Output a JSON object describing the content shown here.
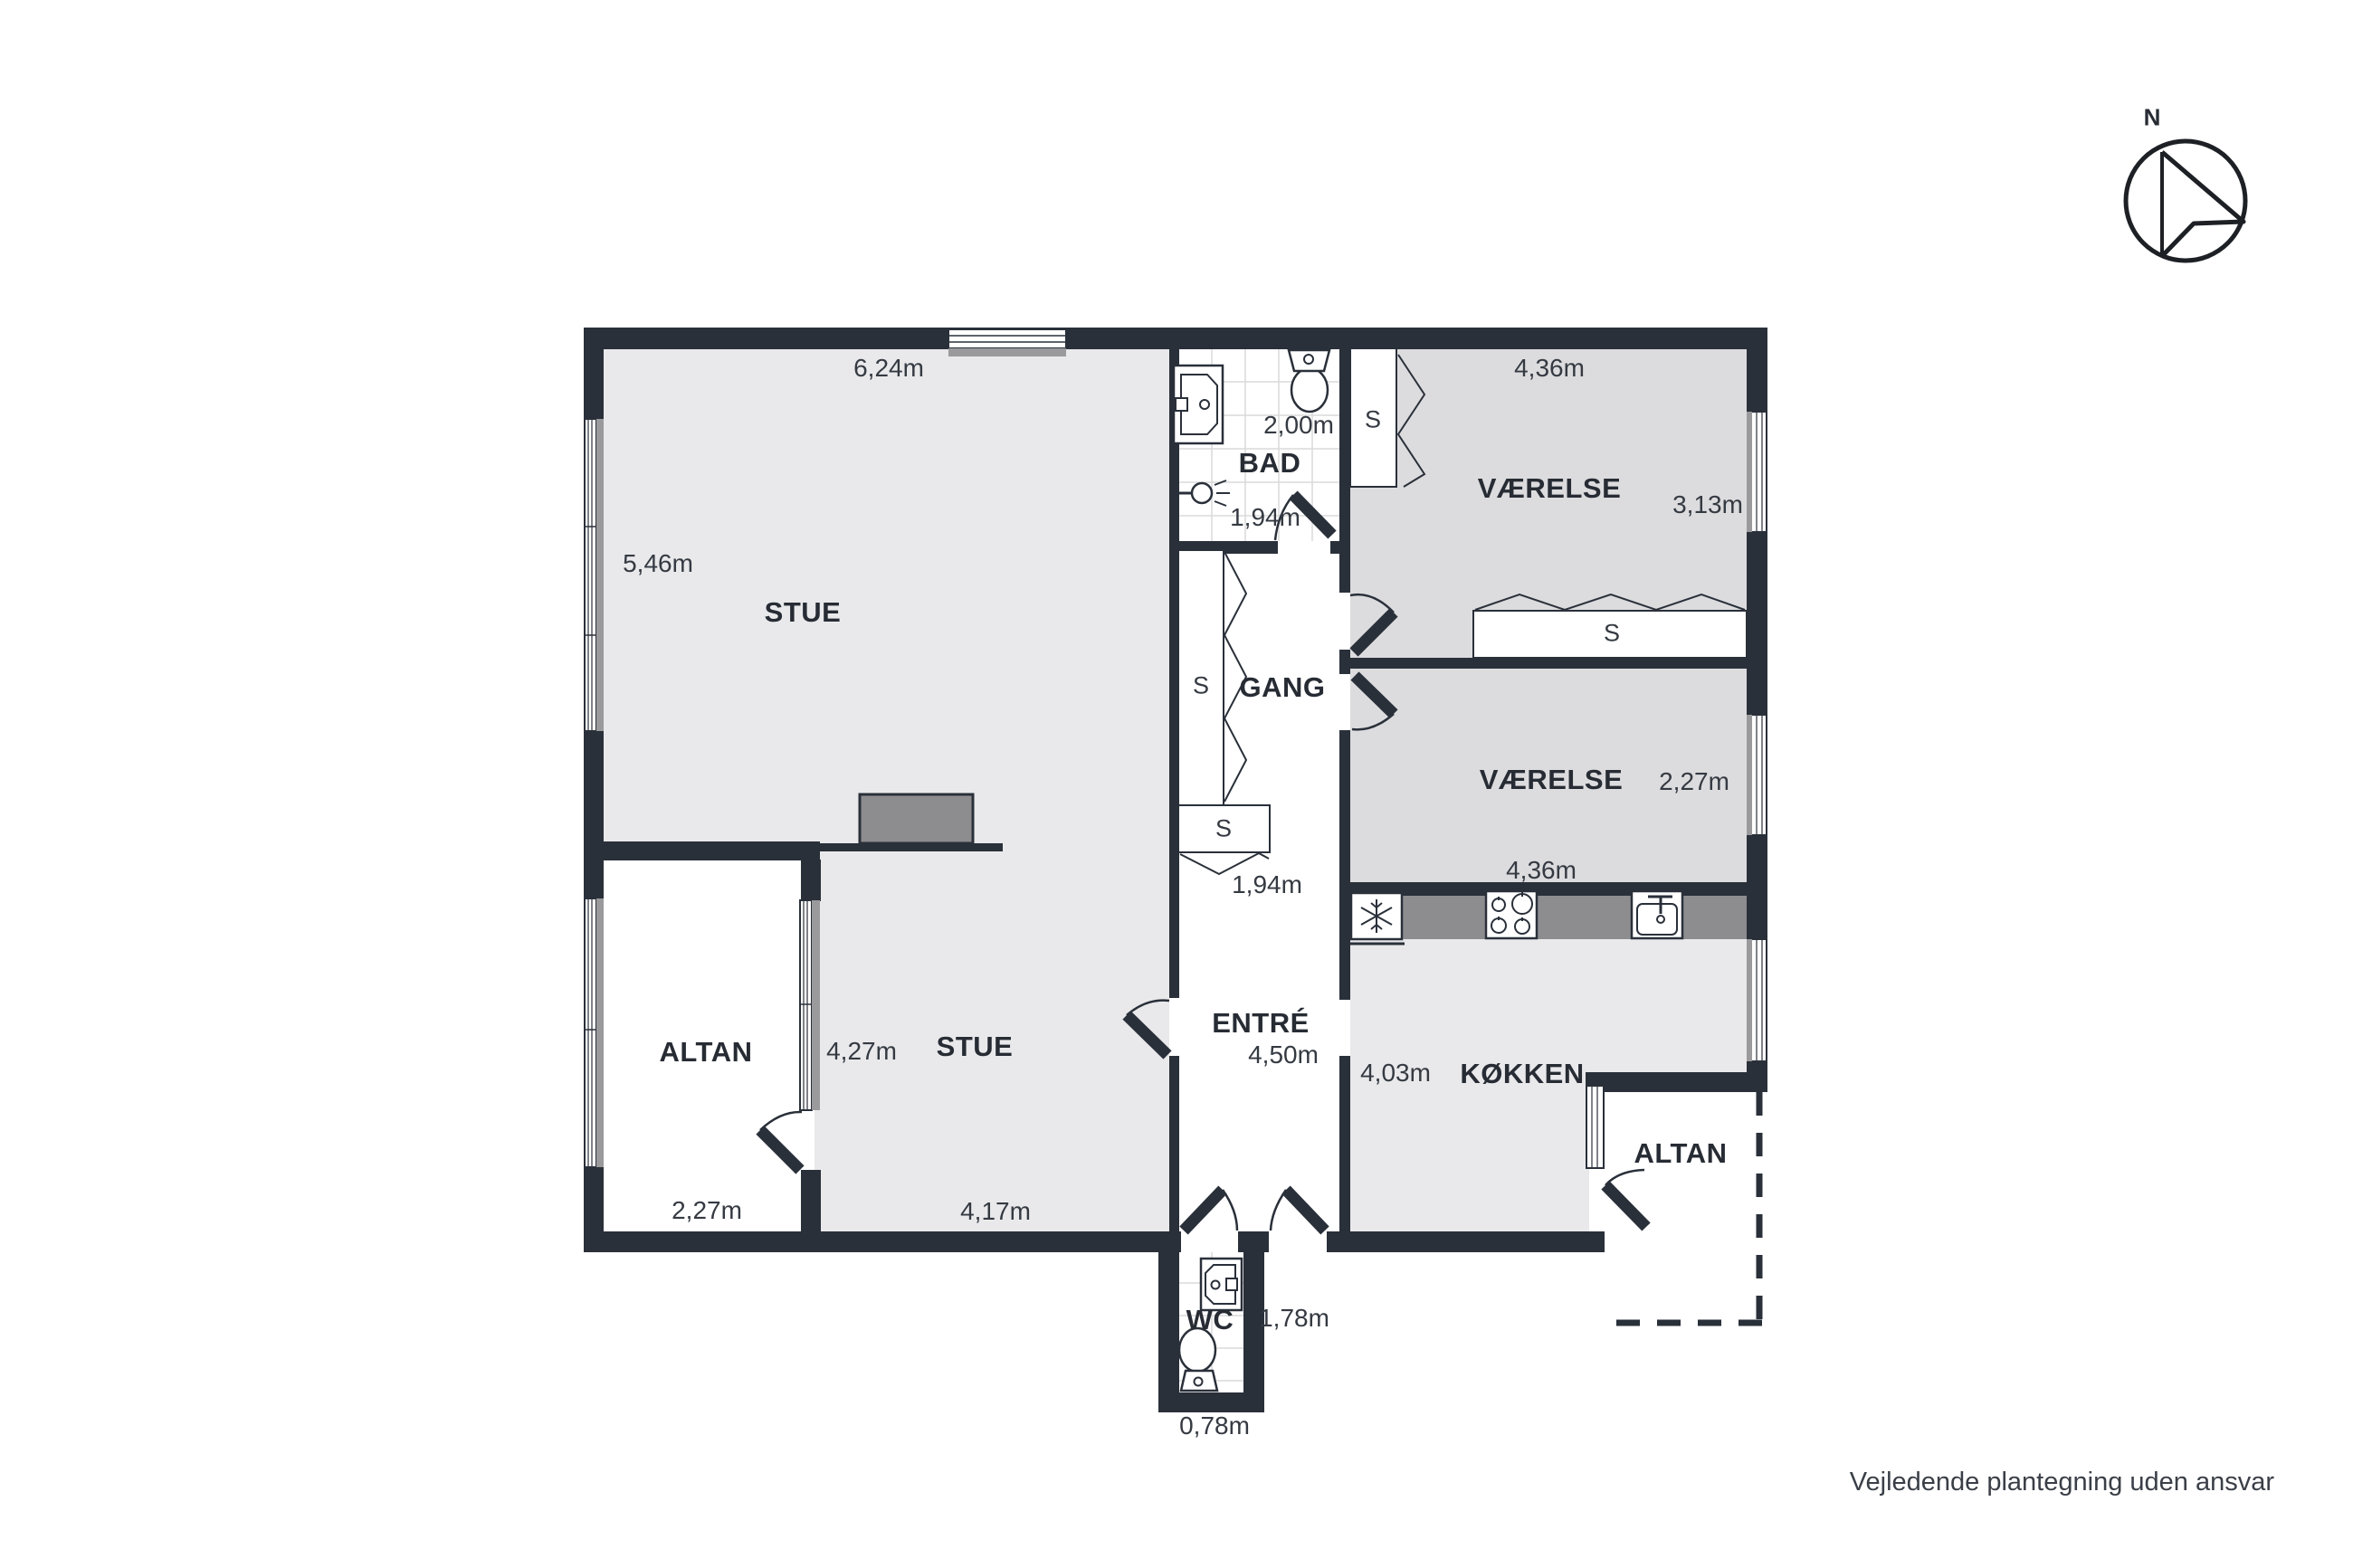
{
  "disclaimer": "Vejledende plantegning uden ansvar",
  "compass": {
    "label": "N"
  },
  "closet_symbol": "S",
  "rooms": {
    "stue1": {
      "name": "STUE",
      "top": "6,24m",
      "left": "5,46m"
    },
    "stue2": {
      "name": "STUE",
      "left": "4,27m",
      "bottom": "4,17m"
    },
    "bad": {
      "name": "BAD",
      "width": "2,00m",
      "depth": "1,94m"
    },
    "gang": {
      "name": "GANG",
      "closet_depth": "1,94m"
    },
    "entre": {
      "name": "ENTRÉ",
      "length": "4,50m"
    },
    "vaerelse1": {
      "name": "VÆRELSE",
      "width": "4,36m",
      "height": "3,13m"
    },
    "vaerelse2": {
      "name": "VÆRELSE",
      "width": "4,36m",
      "height": "2,27m"
    },
    "koekken": {
      "name": "KØKKEN",
      "height": "4,03m"
    },
    "altan_vest": {
      "name": "ALTAN",
      "width": "2,27m"
    },
    "altan_oest": {
      "name": "ALTAN"
    },
    "wc": {
      "name": "WC",
      "length": "1,78m",
      "width": "0,78m"
    }
  },
  "colors": {
    "wall": "#2a303a",
    "room_light": "#e9e9eb",
    "room_dark": "#dcdcde",
    "counter": "#8d8d8f",
    "window_sill": "#9a9a9c"
  }
}
